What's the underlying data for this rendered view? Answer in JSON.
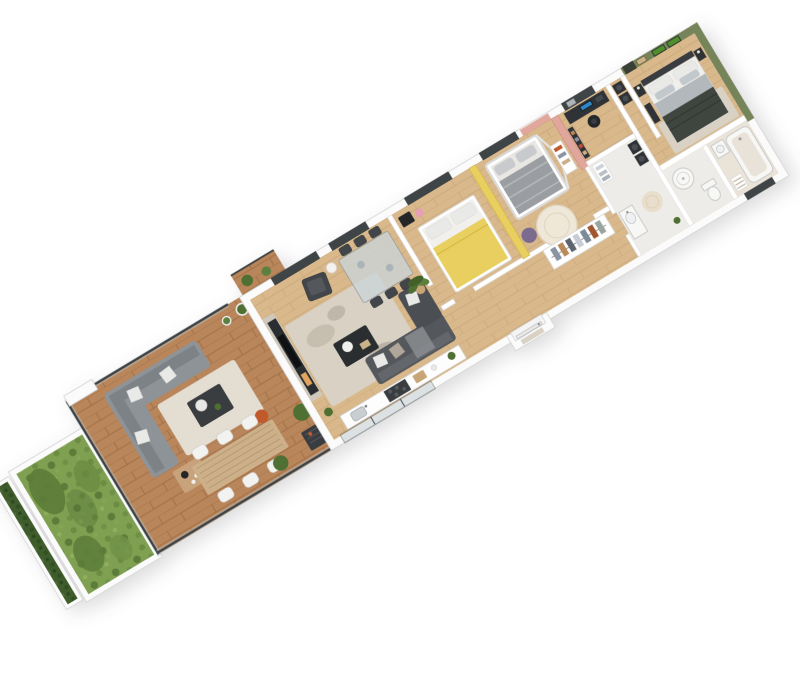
{
  "scene": {
    "description": "3D isometric render of a 3-bedroom apartment floor plan with wood terrace and garden strip, viewed from above on a white background, rotated diagonally bottom-left to top-right",
    "background": "#ffffff",
    "rotation_deg": -31,
    "palette": {
      "wall": "#ffffff",
      "wall_edge": "#d8d8d8",
      "oak_floor": "#d9b98c",
      "deck_wood": "#b9855a",
      "grass": "#7fa051",
      "grass_dark": "#5c7c39",
      "hedge": "#3f5d2c",
      "accent_yellow": "#e8cf5f",
      "accent_pink": "#e2a79c",
      "accent_green": "#76845a",
      "moss_art": "#4e8f2c",
      "sofa_dark": "#54575b",
      "sofa_chaise": "#4b4e52",
      "outdoor_sofa": "#8e9397",
      "living_rug": "#d8d1c4",
      "outdoor_rug": "#e3ddd2",
      "kids_rug": "#efe7d8",
      "bath_rug": "#e8decb",
      "marble_tv_wall": "#cfc9bd",
      "media_unit": "#2b2e31",
      "fireplace_amber": "#e2a45c",
      "glass": "#b7c3c7",
      "frame_dark": "#3f4447",
      "yellow_bedding": "#e8cf5f",
      "master_blanket": "#b3b8bc",
      "master_throw": "#3f453f",
      "kids_blanket": "#9a9da1",
      "rattan_table": "#cdb089",
      "orange_ball": "#c2592b",
      "monitor_screen": "#2f86c9",
      "plant_green": "#4e7032",
      "bbq_dark": "#3a3d40"
    },
    "rooms": [
      {
        "name": "living-dining-room",
        "floor": "oak",
        "furniture": [
          "marble-tv-fireplace-wall",
          "corner-sofa",
          "chaise",
          "coffee-table",
          "area-rug",
          "armchair",
          "side-table-with-lamp",
          "glass-dining-table",
          "dining-chairs-x6",
          "potted-palm",
          "sliding-glass-door"
        ]
      },
      {
        "name": "open-kitchen",
        "floor": "oak",
        "furniture": [
          "counter-run",
          "sink",
          "cooktop",
          "counter-plant"
        ]
      },
      {
        "name": "bedroom-yellow",
        "accent_wall": "#e8cf5f",
        "furniture": [
          "double-bed-yellow-bedding",
          "black-bench",
          "window"
        ]
      },
      {
        "name": "kids-bedroom-pink",
        "accent_wall": "#e2a79c",
        "furniture": [
          "house-frame-bed",
          "round-rug",
          "purple-beanbag",
          "wall-shelf",
          "window"
        ]
      },
      {
        "name": "hallway",
        "floor": "oak",
        "furniture": [
          "open-wardrobe-with-clothes",
          "entry-door-with-mat"
        ]
      },
      {
        "name": "office-nook",
        "furniture": [
          "desk",
          "monitor",
          "task-chair",
          "bookshelf",
          "wall-frame"
        ]
      },
      {
        "name": "bathroom-laundry",
        "floor": "tile",
        "furniture": [
          "stacked-washer-dryer",
          "towel-shelf",
          "vanity-basin",
          "round-rug",
          "plant"
        ]
      },
      {
        "name": "shower-room-wc",
        "floor": "tile",
        "furniture": [
          "round-shower",
          "toilet"
        ]
      },
      {
        "name": "bathroom-2",
        "floor": "warm-tile",
        "furniture": [
          "bathtub",
          "vanity-basin",
          "towel-shelf"
        ]
      },
      {
        "name": "master-bedroom-green",
        "accent_wall": "#76845a",
        "furniture": [
          "double-bed-gray-bedding",
          "dark-throw",
          "nightstands-x2",
          "moss-wall-art-x2",
          "picture-frame",
          "dresser",
          "curtained-doorway",
          "area-rug"
        ]
      },
      {
        "name": "laundry-corridor",
        "furniture": [
          "stacked-appliances"
        ]
      }
    ],
    "outdoor": {
      "terrace": [
        "wood-deck-planks",
        "outdoor-corner-sofa",
        "white-cushions",
        "outdoor-rug",
        "outdoor-coffee-table",
        "tea-tray-mat",
        "orange-ball",
        "outdoor-dining-table-rattan",
        "white-chairs-x6",
        "bbq-grill",
        "boxwood-planters",
        "glass-balustrade",
        "rear-planter-pots"
      ],
      "garden": [
        "lawn",
        "shrub-clusters",
        "white-curb-walls",
        "hedge-planter-row"
      ]
    }
  }
}
